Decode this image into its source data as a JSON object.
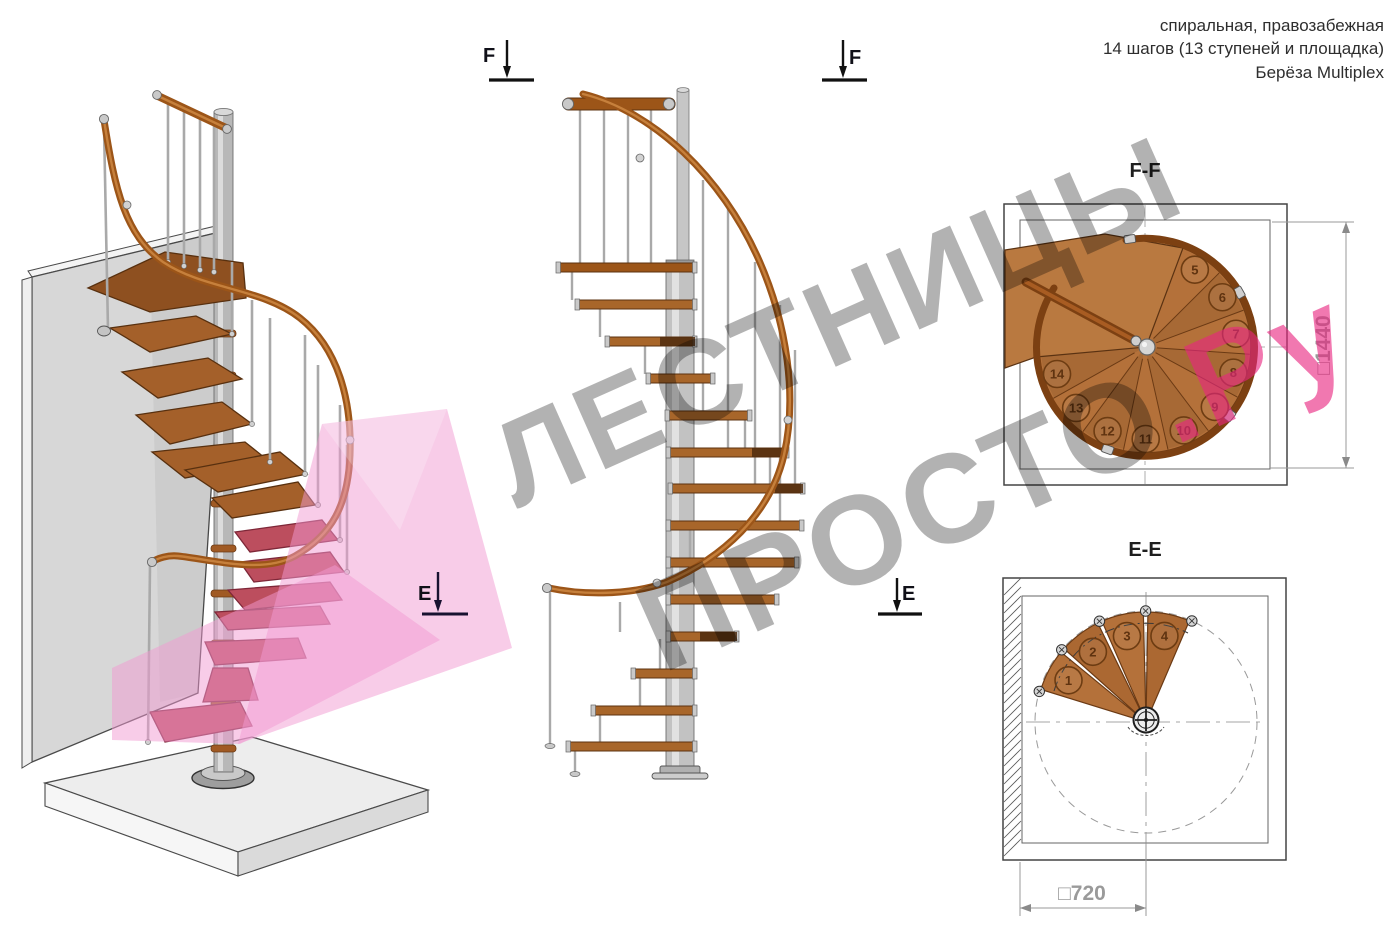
{
  "header": {
    "line1": "спиральная, правозабежная",
    "line2": "14 шагов (13 ступеней и площадка)",
    "line3": "Берёза Multiplex"
  },
  "watermark": {
    "line1": "ЛЕСТНИЦЫ",
    "line2_gray": "ПРОСТО",
    "line2_pink": ".Ру"
  },
  "sections": {
    "f_label": "F",
    "e_label": "E",
    "ff_title": "F-F",
    "ee_title": "E-E"
  },
  "dimensions": {
    "ff_square_height": "□1440",
    "ee_square_width": "□720"
  },
  "plan_ff": {
    "step_numbers": [
      5,
      6,
      7,
      8,
      9,
      10,
      11,
      12,
      13,
      14
    ]
  },
  "plan_ee": {
    "step_numbers": [
      1,
      2,
      3,
      4
    ]
  },
  "colors": {
    "wood_step": "#a8662a",
    "wood_dark_edge": "#5d3310",
    "handrail": "#9c5518",
    "crimson_step": "#bc4e5e",
    "pink_plane": "#f29ad2",
    "metal": "#c2c2c2",
    "wall": "#d7d7d7",
    "floor": "#ededed",
    "plan_wood": "#b4713a",
    "drawing_line": "#444444",
    "dimension_text": "#9a9a9a",
    "number_brown": "#5f3310",
    "watermark_gray": "rgba(0,0,0,0.30)",
    "watermark_pink": "rgba(232,37,127,0.62)"
  }
}
